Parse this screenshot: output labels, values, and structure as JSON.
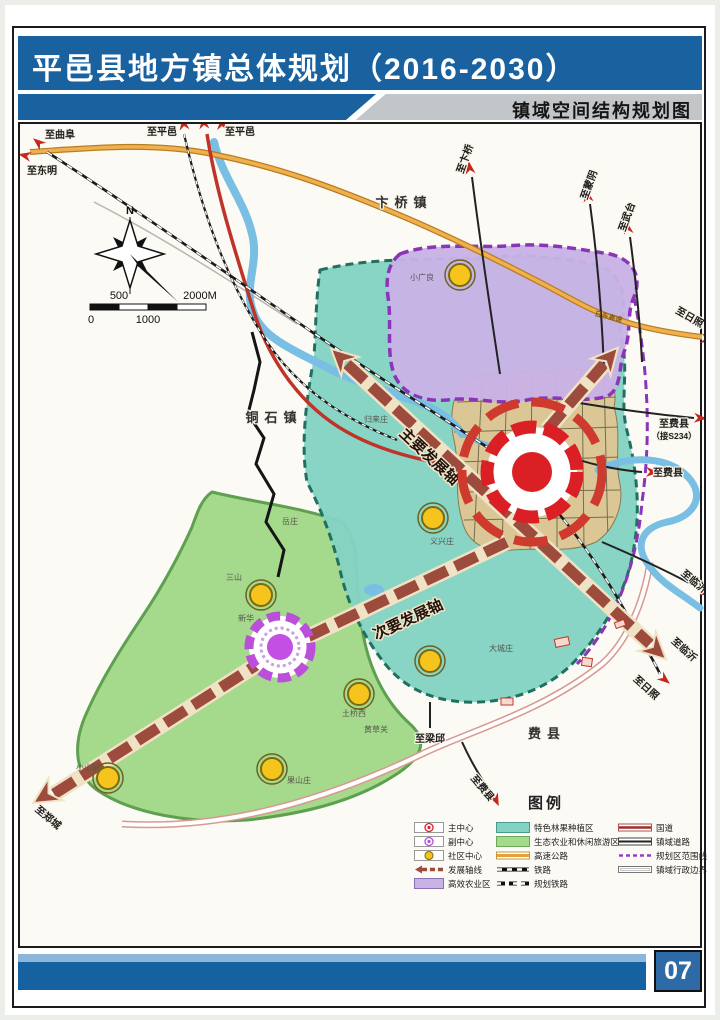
{
  "header": {
    "title": "平邑县地方镇总体规划（2016-2030）",
    "subtitle": "镇域空间结构规划图"
  },
  "footer": {
    "page_number": "07"
  },
  "compass": {
    "north": "N"
  },
  "scale_bar": {
    "labels": [
      "500",
      "2000M",
      "0",
      "1000"
    ]
  },
  "map": {
    "towns": [
      "卞桥镇",
      "铜石镇",
      "费县"
    ],
    "axis": {
      "main": "主要发展轴",
      "secondary": "次要发展轴"
    },
    "road_labels": [
      "至曲阜",
      "至东明",
      "至平邑",
      "至平邑",
      "至卞桥",
      "至蒙阴",
      "至武台",
      "至日照",
      "日东高速",
      "至费县",
      "（接S234）",
      "至费县",
      "至临沂",
      "至临沂",
      "至日照",
      "至郑城",
      "至梁邱",
      "至费县"
    ],
    "villages": [
      "小广良",
      "归来庄",
      "岳庄",
      "义兴庄",
      "三山",
      "新华",
      "大城庄",
      "土桥西",
      "黄草关",
      "果山庄",
      "小山前"
    ]
  },
  "legend": {
    "title": "图例",
    "col1": [
      "主中心",
      "副中心",
      "社区中心",
      "发展轴线",
      "高效农业区"
    ],
    "col2": [
      "特色林果种植区",
      "生态农业和休闲旅游区",
      "高速公路",
      "铁路",
      "规划铁路"
    ],
    "col3": [
      "国道",
      "镇域道路",
      "规划区范围线",
      "镇域行政边界"
    ]
  },
  "colors": {
    "header_blue": "#19629f",
    "zone_purple": "#c9b2e6",
    "zone_teal": "#83d2c3",
    "zone_green": "#a5d98b",
    "urban_tan": "#dbc795",
    "axis_brown": "#9c4b3c",
    "main_center_red": "#da2025",
    "sub_center_purple": "#c44fe4",
    "community_yellow": "#f5c41d",
    "expressway_orange": "#e5a23c",
    "national_road_red": "#c03328",
    "river_blue": "#79bfe4"
  }
}
